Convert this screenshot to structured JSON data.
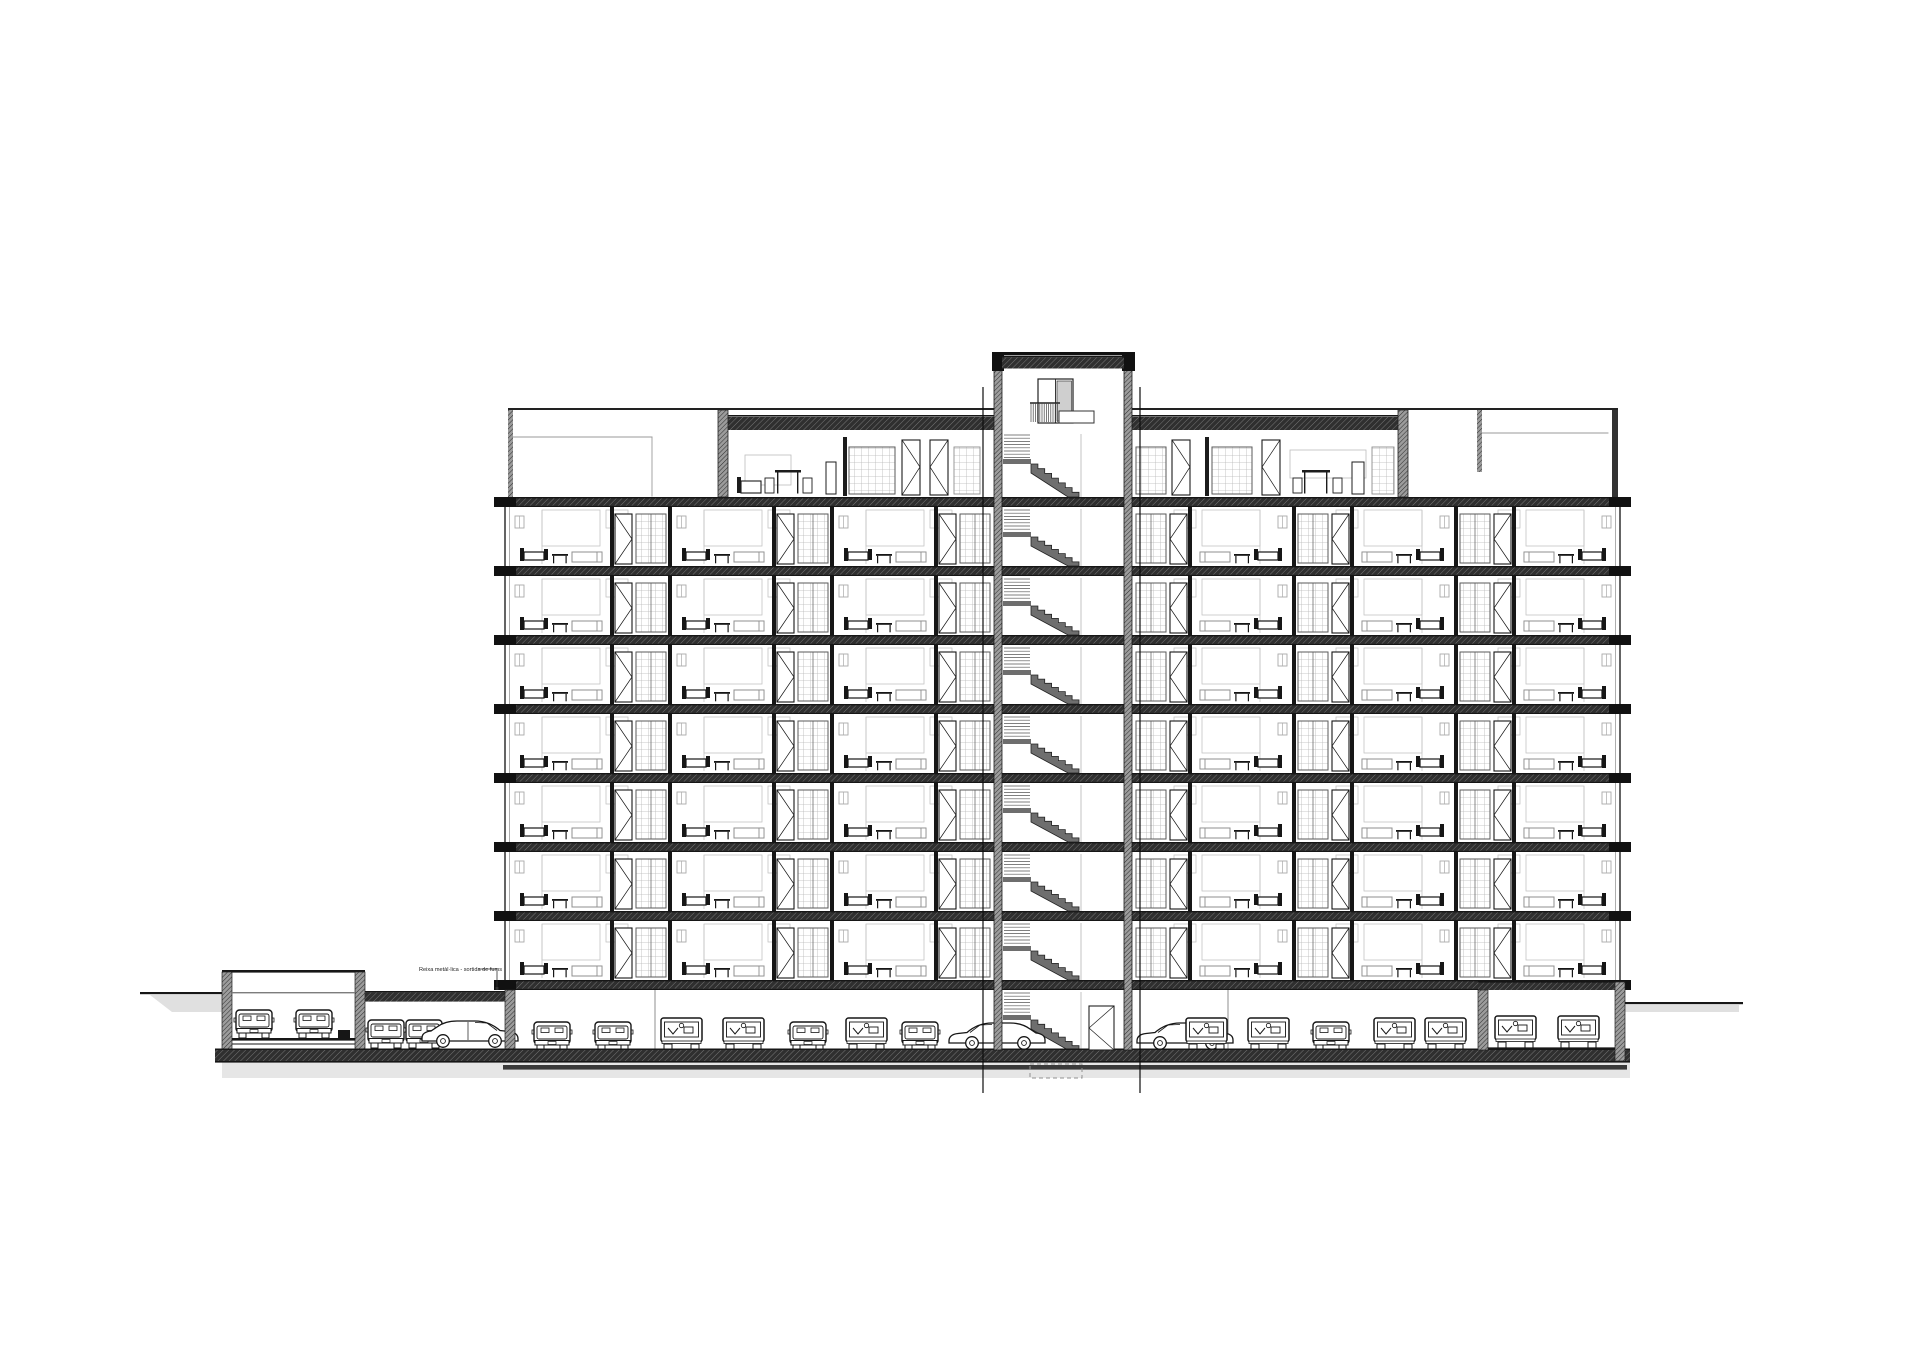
{
  "page": {
    "background": "#ffffff",
    "description": "architectural cross-section drawing of a residential building with underground parking"
  },
  "annotation": {
    "label": "Reixa metàl·lica - sortida de fums"
  },
  "drawing": {
    "colors": {
      "ink": "#161616",
      "wall_fill": "#9c9c9c",
      "wall_line": "#2b2b2b",
      "slab_fill": "#2f2f2f",
      "gray_light": "#bdbdbd",
      "gray_mid": "#8f8f8f",
      "shadow": "#e0e0e0",
      "door_panel": "#cfcfcf"
    },
    "building": {
      "x0": 500,
      "x1": 1625,
      "slab_y0": 497,
      "floor_spacing": 69,
      "slab_h": 10,
      "typical_floors": 7,
      "left_zone_cells_x": [
        508,
        670,
        832
      ],
      "right_zone_cells_x": [
        1132,
        1294,
        1456
      ],
      "cell_w": 162
    },
    "attic": {
      "roof_y": 416,
      "floor_y": 497,
      "parapet_y": 408
    },
    "tower": {
      "x0": 994,
      "x1": 1132,
      "wall_w": 8,
      "top_y": 354
    },
    "stairs": {
      "x_ladder": 1004,
      "x_mid": 1031,
      "x_end": 1079,
      "interiors": [
        [
          432,
          497
        ],
        [
          507,
          566
        ],
        [
          576,
          635
        ],
        [
          645,
          704
        ],
        [
          714,
          773
        ],
        [
          783,
          842
        ],
        [
          852,
          911
        ],
        [
          921,
          980
        ],
        [
          990,
          1050
        ]
      ]
    },
    "parking": {
      "ceiling_y": 980,
      "floor_y": 1050,
      "columns_x": [
        655,
        1228
      ],
      "cars": [
        {
          "type": "front",
          "x": 234,
          "y": 1038
        },
        {
          "type": "front",
          "x": 294,
          "y": 1038
        },
        {
          "type": "front",
          "x": 366,
          "y": 1048
        },
        {
          "type": "front",
          "x": 404,
          "y": 1048
        },
        {
          "type": "side",
          "x": 420,
          "y": 1048,
          "flip": true
        },
        {
          "type": "front",
          "x": 532,
          "y": 1050
        },
        {
          "type": "front",
          "x": 593,
          "y": 1050
        },
        {
          "type": "van",
          "x": 660,
          "y": 1050
        },
        {
          "type": "van",
          "x": 722,
          "y": 1050
        },
        {
          "type": "front",
          "x": 788,
          "y": 1050
        },
        {
          "type": "van",
          "x": 845,
          "y": 1050
        },
        {
          "type": "front",
          "x": 900,
          "y": 1050
        },
        {
          "type": "side",
          "x": 947,
          "y": 1050
        },
        {
          "type": "side",
          "x": 1135,
          "y": 1050
        },
        {
          "type": "van",
          "x": 1185,
          "y": 1050
        },
        {
          "type": "van",
          "x": 1247,
          "y": 1050
        },
        {
          "type": "front",
          "x": 1311,
          "y": 1050
        },
        {
          "type": "van",
          "x": 1373,
          "y": 1050
        },
        {
          "type": "van",
          "x": 1424,
          "y": 1050
        },
        {
          "type": "van",
          "x": 1494,
          "y": 1048
        },
        {
          "type": "van",
          "x": 1557,
          "y": 1048
        }
      ]
    },
    "section_lines": {
      "xs": [
        983,
        1140
      ],
      "y0": 387,
      "y1": 1093
    }
  }
}
